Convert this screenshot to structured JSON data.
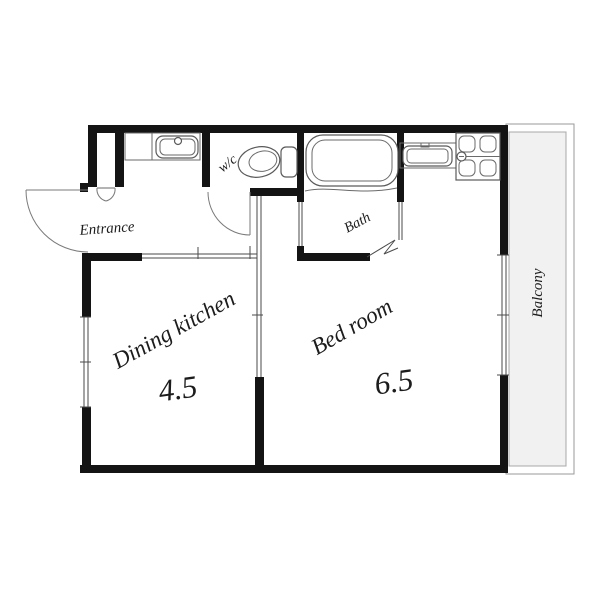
{
  "floor_plan": {
    "title": "1DK apartment floor plan",
    "rooms": {
      "entrance": {
        "label": "Entrance"
      },
      "wc": {
        "label": "w/c"
      },
      "bath": {
        "label": "Bath"
      },
      "dining_kitchen": {
        "label": "Dining kitchen",
        "size": "4.5"
      },
      "bedroom": {
        "label": "Bed room",
        "size": "6.5"
      },
      "balcony": {
        "label": "Balcony"
      }
    },
    "fixtures": [
      "entrance-door",
      "shoe-closet",
      "washbasin",
      "toilet",
      "bathtub",
      "bifold-bath-door",
      "kitchen-sink",
      "gas-stove",
      "sliding-partition",
      "window",
      "balcony-glass-door"
    ],
    "colors": {
      "wall": "#141414",
      "line": "#4a4a4a",
      "balcony_fill": "#f1f1f1",
      "background": "#ffffff"
    }
  }
}
